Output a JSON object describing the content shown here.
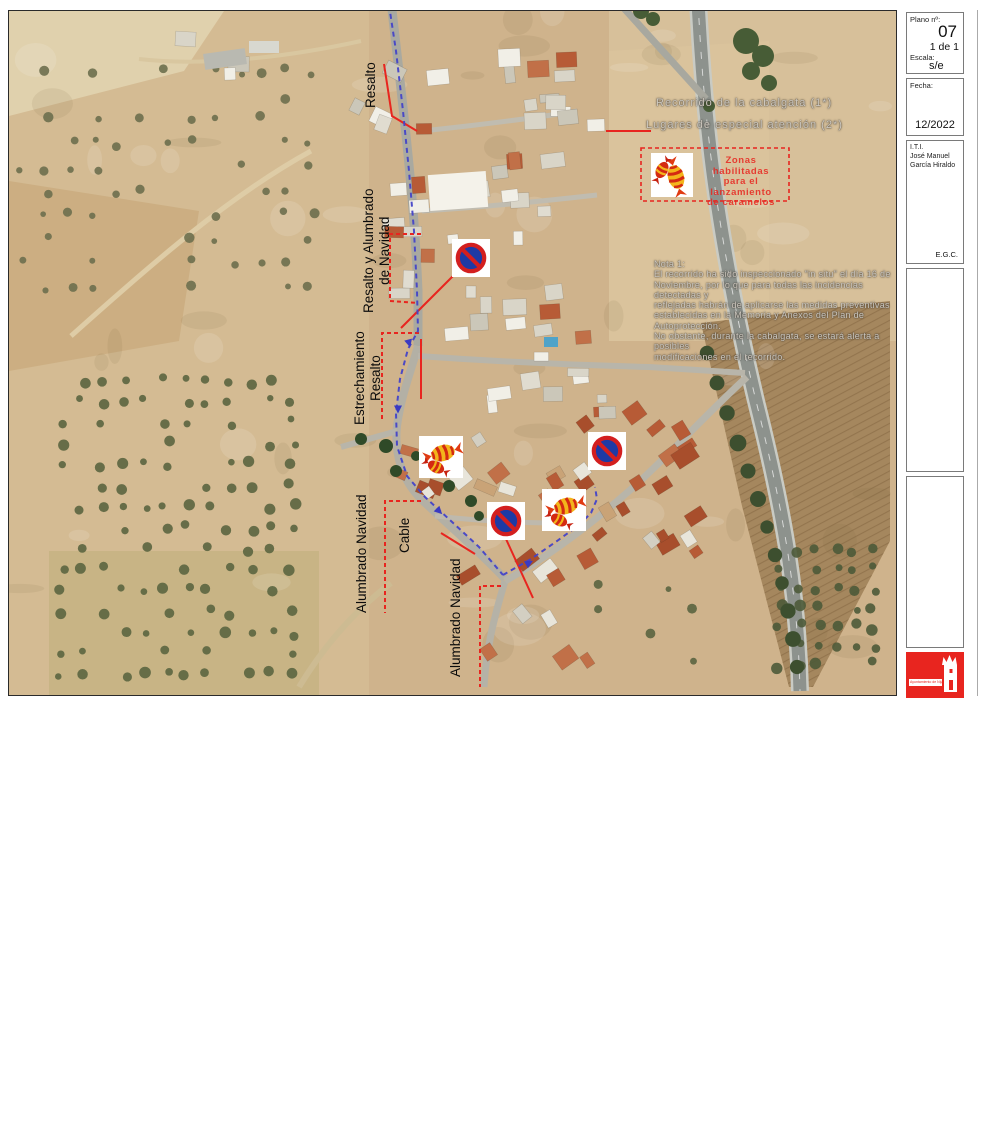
{
  "title_block": {
    "plano_label": "Plano nº:",
    "plano_value": "07",
    "plano_pages": "1 de 1",
    "escala_label": "Escala:",
    "escala_value": "s/e",
    "fecha_label": "Fecha:",
    "fecha_value": "12/2022",
    "author_title": "I.T.I.",
    "author_first": "José Manuel",
    "author_last": "García Hiraldo",
    "reviewer": "E.G.C.",
    "plano_de_label": "Plano de:",
    "plano_de_value": "Itinerario de Cabalgata en Fernán Pérez",
    "plan_title_lines": [
      "Plan de Autoprotección, Emergencias y Evacuación",
      "de las CABALGATAS DE REYES en diferentes",
      "Núcleos del Término Municipal de Níjar"
    ],
    "logo_text": "Ayuntamiento de Níjar"
  },
  "legend": {
    "route_label": "Recorrido de la cabalgata (1*)",
    "attention_label": "Lugares de especial atención (2*)",
    "candy_zone_lines": [
      "Zonas habilitadas",
      "para el lanzamiento",
      "de caramelos"
    ]
  },
  "note": {
    "title": "Nota 1:",
    "lines": [
      "El recorrido ha sido inspeccionado \"in situ\" el día 16 de",
      "Noviembre, por lo que para todas las incidencias detectadas y",
      "reflejadas habrán de aplicarse las medidas preventivas",
      "establecidas en la Memoria y Anexos del Plan de Autoprotección.",
      "No obstante, durante la cabalgata, se estará alerta a posibles",
      "modificaciones en el recorrido."
    ]
  },
  "map_labels": {
    "resalto_top": "Resalto",
    "resalto_alumbrado": [
      "Resalto y Alumbrado",
      "de Navidad"
    ],
    "estrechamiento": [
      "Estrechamiento",
      "Resalto"
    ],
    "alumbrado_left": "Alumbrado Navidad",
    "cable": "Cable",
    "alumbrado_bottom": "Alumbrado Navidad"
  },
  "icons": {
    "no_parking_sign": "no-parking-sign",
    "candy_zone_icon": "candy-icon"
  },
  "colors": {
    "route_blue": "#4343c8",
    "annotation_red": "#e8251f",
    "sign_blue": "#1d3aa5",
    "sign_red": "#d31f1f",
    "logo_red": "#e8251f"
  }
}
